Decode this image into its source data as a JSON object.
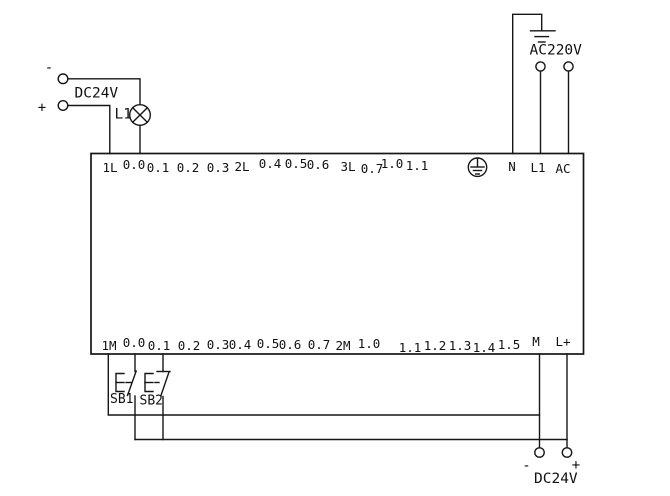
{
  "colors": {
    "line": "#161616",
    "text": "#111111",
    "background": "#ffffff"
  },
  "power_supply_top_left": {
    "label": "DC24V",
    "minus_sign": "-",
    "plus_sign": "+"
  },
  "indicator_lamp": {
    "label": "L1"
  },
  "power_supply_top_right": {
    "label": "AC220V"
  },
  "power_supply_bottom_right": {
    "label": "DC24V",
    "minus_sign": "-",
    "plus_sign": "+"
  },
  "pushbuttons": {
    "sb1": "SB1",
    "sb2": "SB2"
  },
  "plc": {
    "top_terminals": [
      "1L",
      "0.0",
      "0.1",
      "0.2",
      "0.3",
      "2L",
      "0.4",
      "0.5",
      "0.6",
      "3L",
      "0.7",
      "1.0",
      "1.1",
      "N",
      "L1",
      "AC"
    ],
    "bottom_terminals": [
      "1M",
      "0.0",
      "0.1",
      "0.2",
      "0.3",
      "0.4",
      "0.5",
      "0.6",
      "0.7",
      "2M",
      "1.0",
      "1.1",
      "1.2",
      "1.3",
      "1.4",
      "1.5",
      "M",
      "L+"
    ]
  },
  "icons": {
    "earth_ground": "earth-ground",
    "protective_earth": "protective-earth-in-circle",
    "lamp": "lamp-cross-circle"
  }
}
